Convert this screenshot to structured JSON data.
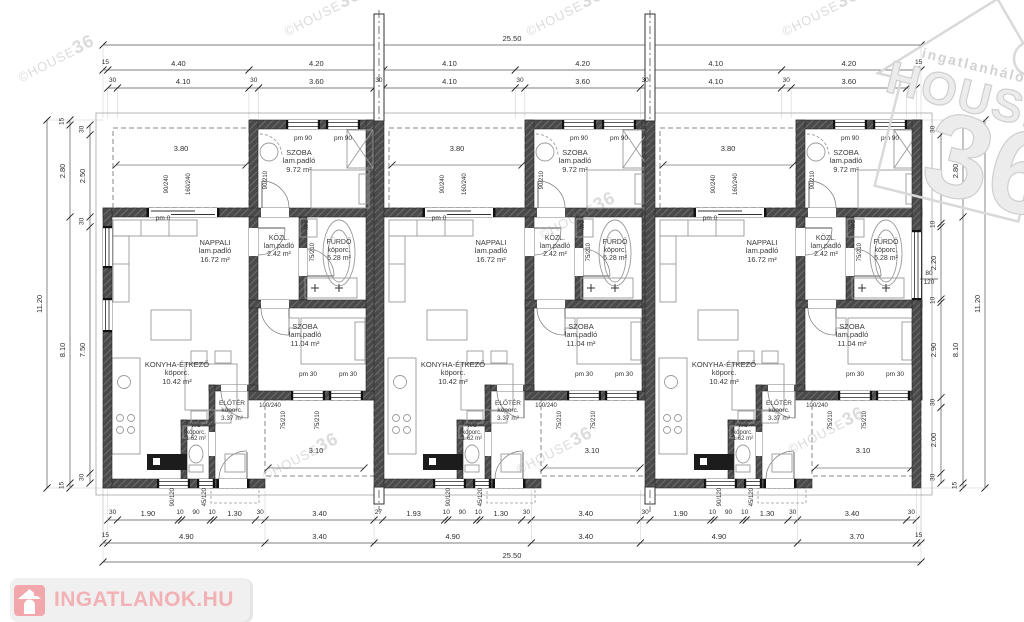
{
  "watermarks": {
    "small_prefix": "©HOUSE",
    "small_num": "36",
    "brand_top": "ingatlanhálózat",
    "brand_mid": "HOUSE",
    "brand_num": "36"
  },
  "footer_logo": {
    "text": "INGATLANOK.HU"
  },
  "colors": {
    "wall": "#4a4a4a",
    "hatch_line": "#767676",
    "dim_text": "#2e2e2e",
    "furniture": "#9a9a9a",
    "logo_pink": "#f1abaf",
    "logo_bg": "#efefef",
    "watermark_gray": "#d2d2d2"
  },
  "unit": {
    "rooms": [
      {
        "id": "szoba-top",
        "name": "SZOBA",
        "floor": "lam.padló",
        "area": "9.72 m²"
      },
      {
        "id": "nappali",
        "name": "NAPPALI",
        "floor": "lam.padló",
        "area": "16.72 m²"
      },
      {
        "id": "kozl",
        "name": "KÖZL.",
        "floor": "lam.padló",
        "area": "2.42 m²"
      },
      {
        "id": "furdo",
        "name": "FÜRDŐ",
        "floor": "köporc.",
        "area": "5.28 m²"
      },
      {
        "id": "konyha",
        "name": "KONYHA-ÉTKEZŐ",
        "floor": "köporc.",
        "area": "10.42 m²"
      },
      {
        "id": "eloter",
        "name": "ELŐTÉR",
        "floor": "köporc.",
        "area": "3.37 m²"
      },
      {
        "id": "wc",
        "name": "WC",
        "floor": "köporc.",
        "area": "1.62 m²"
      },
      {
        "id": "szoba-bottom",
        "name": "SZOBA",
        "floor": "lam.padló",
        "area": "11.04 m²"
      }
    ],
    "marks": {
      "terrace": "3.80",
      "porch": "3.10",
      "pm0": "pm 0",
      "pm90": "pm 90",
      "pm30": "pm 30",
      "ms": "M/S",
      "door_terrace": "160/240",
      "win_nappali": "90/240",
      "door_kozl": "90/210",
      "door_furdo": "75/210",
      "door_szoba2": "100/240",
      "porch_door": "75/210",
      "win_k1": "90/120",
      "win_k2": "45/120"
    }
  },
  "dims": {
    "top1": [
      "25.50"
    ],
    "top2": [
      "15",
      "4.40",
      "4.20",
      "4.10",
      "4.20",
      "4.10",
      "4.20",
      "15"
    ],
    "top3": [
      "30",
      "4.10",
      "30",
      "3.60",
      "30",
      "4.10",
      "30",
      "3.60",
      "30",
      "4.10",
      "30",
      "3.60",
      "30"
    ],
    "bottom1": [
      "30",
      "1.90",
      "10",
      "90",
      "10",
      "1.30",
      "30",
      "3.40",
      "27",
      "1.93",
      "10",
      "90",
      "10",
      "1.30",
      "30",
      "3.40",
      "30",
      "1.90",
      "10",
      "90",
      "10",
      "1.30",
      "30",
      "3.40",
      "30"
    ],
    "bottom2": [
      "15",
      "4.90",
      "3.40",
      "4.90",
      "3.40",
      "4.90",
      "3.70",
      "15"
    ],
    "bottom3": [
      "25.50"
    ],
    "left_outer": [
      "11.20"
    ],
    "left_mid": [
      "15",
      "2.80",
      "8.10",
      "15"
    ],
    "left_inner": [
      "30",
      "2.50",
      "30",
      "7.50",
      "30"
    ],
    "right_inner": [
      "30",
      "2.70",
      "10",
      "2.20",
      "10",
      "2.90",
      "30",
      "2.00",
      "30"
    ],
    "right_mid": [
      "15",
      "2.80",
      "8.10",
      "15"
    ],
    "right_outer": [
      "11.20"
    ],
    "window_right": [
      "80",
      "120"
    ]
  }
}
